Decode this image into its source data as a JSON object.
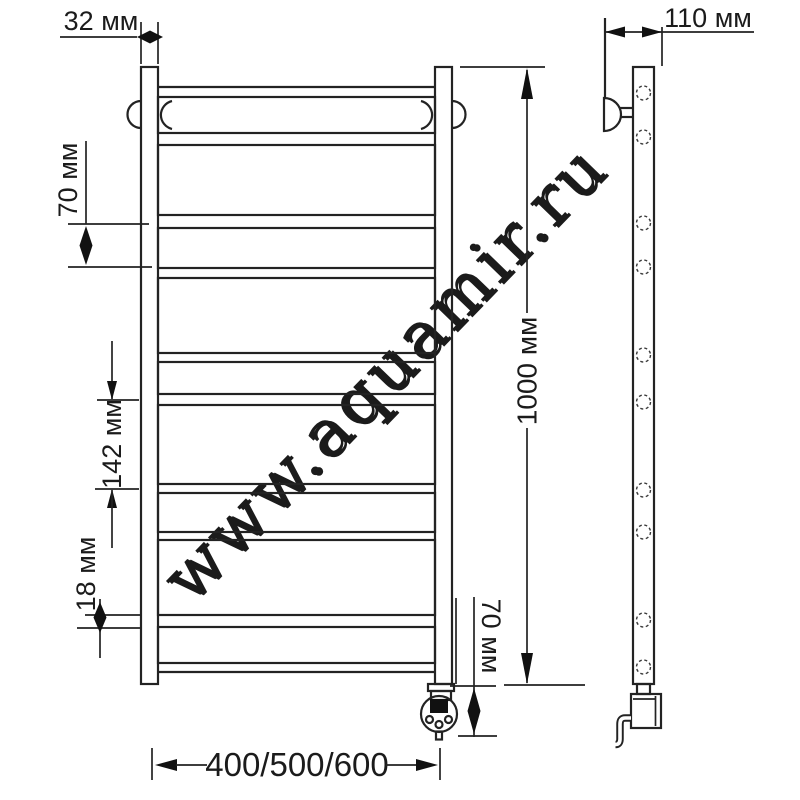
{
  "labels": {
    "tube_width": "32 мм",
    "wall_depth": "110 мм",
    "rung_pitch": "70 мм",
    "section_spacing": "142 мм",
    "bottom_rung_gap": "18 мм",
    "total_height": "1000 мм",
    "heater_drop": "70 мм",
    "width_options": "400/500/600"
  },
  "watermark": "www.aquamir.ru",
  "colors": {
    "line": "#232323",
    "background": "#ffffff",
    "watermark": "#e3e3e3",
    "watermark_highlight": "#ffffff"
  }
}
